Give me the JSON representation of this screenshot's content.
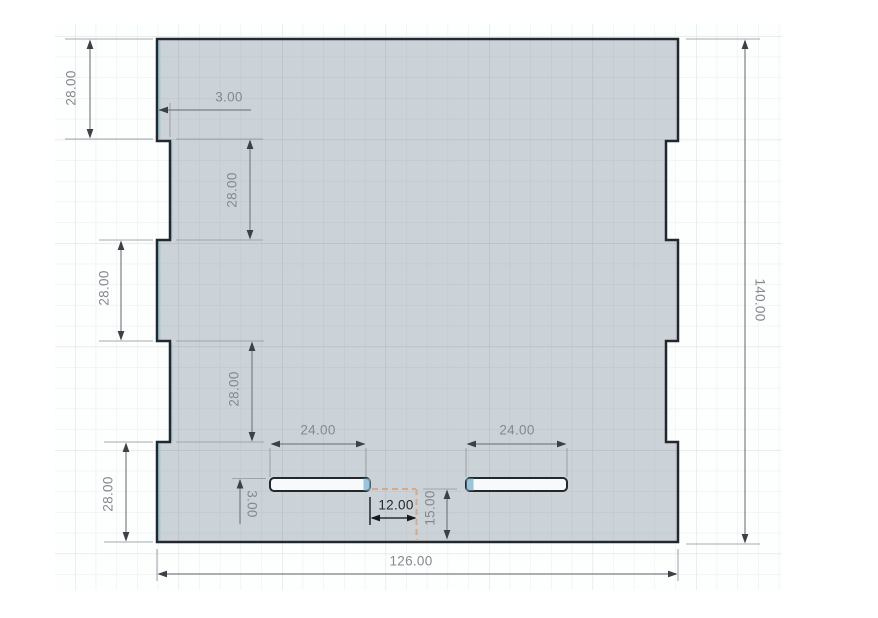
{
  "canvas": {
    "app_context": "cad-sketch-view",
    "grid_visible": true
  },
  "colors": {
    "panel_fill": "#ccd3d8",
    "outline": "#23282e",
    "slot_fill": "#f7f9fa",
    "accent_blue": "#7fb3cd",
    "construction_dashed": "#d8a888",
    "dimension_gray": "#7a8084",
    "dimension_active": "#24282c",
    "grid_minor_outside": "#e9eced",
    "grid_major_outside": "#dee2e5",
    "grid_minor_inside": "#bdc5ca",
    "grid_major_inside": "#b3bbc1"
  },
  "dimensions": {
    "left_top": "28.00",
    "top_notch_depth": "3.00",
    "left_upper_inner": "28.00",
    "left_middle": "28.00",
    "left_lower_inner": "28.00",
    "left_bottom": "28.00",
    "overall_height": "140.00",
    "overall_width": "126.00",
    "slot_left_length": "24.00",
    "slot_right_length": "24.00",
    "slot_offset_center": "12.00",
    "slot_height": "3.00",
    "slot_bottom_offset": "15.00"
  }
}
